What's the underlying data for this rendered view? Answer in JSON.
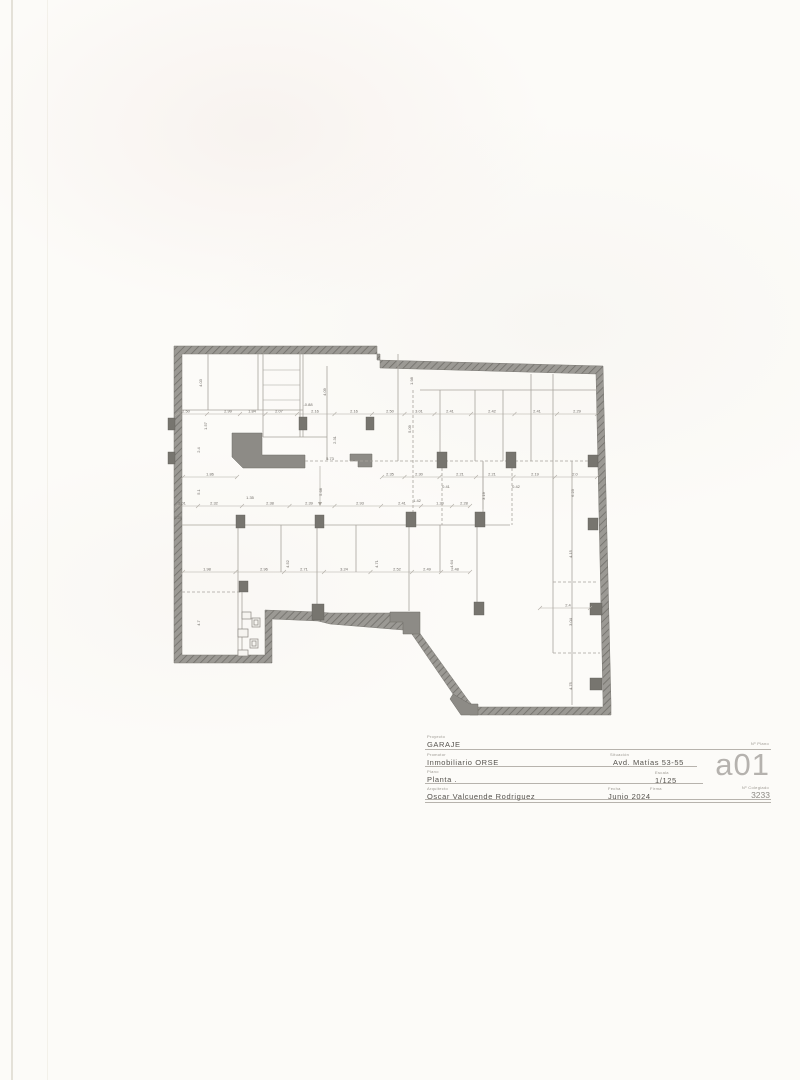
{
  "colors": {
    "paper": "#fcfbf8",
    "wall_fill": "#9b9994",
    "wall_hatch": "#716f6a",
    "dark_fill": "#77756f",
    "line": "#a8a49d",
    "dimline": "#b0aca4",
    "dim_text": "#6f6b66",
    "title_text": "#55524d",
    "label_text": "#9a968f",
    "plan_number_color": "#b5b2ae"
  },
  "plan": {
    "dim_rows": [
      {
        "y": 414,
        "x1": 177,
        "x2": 597,
        "labels": [
          {
            "x": 186,
            "t": "2.50"
          },
          {
            "x": 228,
            "t": "2.99"
          },
          {
            "x": 252,
            "t": "1.84"
          },
          {
            "x": 279,
            "t": "2.07"
          },
          {
            "x": 315,
            "t": "2.16"
          },
          {
            "x": 354,
            "t": "2.16"
          },
          {
            "x": 390,
            "t": "2.50"
          },
          {
            "x": 419,
            "t": "3.01"
          },
          {
            "x": 450,
            "t": "2.41"
          },
          {
            "x": 492,
            "t": "2.42"
          },
          {
            "x": 537,
            "t": "2.41"
          },
          {
            "x": 577,
            "t": "2.29"
          }
        ]
      },
      {
        "y": 477,
        "x1": 382,
        "x2": 597,
        "labels": [
          {
            "x": 390,
            "t": "2.35"
          },
          {
            "x": 419,
            "t": "2.30"
          },
          {
            "x": 460,
            "t": "2.21"
          },
          {
            "x": 492,
            "t": "2.21"
          },
          {
            "x": 535,
            "t": "2.19"
          },
          {
            "x": 575,
            "t": "2.0"
          }
        ]
      },
      {
        "y": 477,
        "x1": 183,
        "x2": 237,
        "labels": [
          {
            "x": 210,
            "t": "1.86"
          }
        ]
      },
      {
        "y": 506,
        "x1": 177,
        "x2": 470,
        "labels": [
          {
            "x": 182,
            "t": "2.01"
          },
          {
            "x": 214,
            "t": "2.32"
          },
          {
            "x": 270,
            "t": "2.38"
          },
          {
            "x": 309,
            "t": "2.39"
          },
          {
            "x": 360,
            "t": "2.93"
          },
          {
            "x": 402,
            "t": "2.41"
          },
          {
            "x": 440,
            "t": "1.20"
          },
          {
            "x": 464,
            "t": "2.28"
          }
        ]
      },
      {
        "y": 572,
        "x1": 183,
        "x2": 470,
        "labels": [
          {
            "x": 207,
            "t": "1.98"
          },
          {
            "x": 264,
            "t": "2.96"
          },
          {
            "x": 304,
            "t": "2.71"
          },
          {
            "x": 344,
            "t": "3.24"
          },
          {
            "x": 397,
            "t": "2.52"
          },
          {
            "x": 427,
            "t": "2.49"
          },
          {
            "x": 455,
            "t": "2.48"
          }
        ]
      },
      {
        "y": 608,
        "x1": 540,
        "x2": 590,
        "labels": [
          {
            "x": 568,
            "t": "2.4"
          }
        ]
      }
    ],
    "vdims": [
      {
        "x": 202,
        "y": 383,
        "t": "4.03"
      },
      {
        "x": 207,
        "y": 426,
        "t": "1.57"
      },
      {
        "x": 200,
        "y": 450,
        "t": "2.4"
      },
      {
        "x": 200,
        "y": 492,
        "t": "5.1"
      },
      {
        "x": 326,
        "y": 392,
        "t": "4.09"
      },
      {
        "x": 336,
        "y": 440,
        "t": "2.31"
      },
      {
        "x": 322,
        "y": 492,
        "t": "5.68"
      },
      {
        "x": 413,
        "y": 381,
        "t": "1.98"
      },
      {
        "x": 411,
        "y": 429,
        "t": "5.09"
      },
      {
        "x": 485,
        "y": 496,
        "t": "3.19"
      },
      {
        "x": 574,
        "y": 493,
        "t": "6.23"
      },
      {
        "x": 289,
        "y": 564,
        "t": "4.52"
      },
      {
        "x": 378,
        "y": 564,
        "t": "4.71"
      },
      {
        "x": 453,
        "y": 564,
        "t": "4.64"
      },
      {
        "x": 572,
        "y": 554,
        "t": "4.15"
      },
      {
        "x": 572,
        "y": 622,
        "t": "3.04"
      },
      {
        "x": 572,
        "y": 686,
        "t": "4.75"
      },
      {
        "x": 200,
        "y": 623,
        "t": "4.7"
      }
    ],
    "labels": [
      {
        "x": 308,
        "y": 406,
        "t": "-0.88"
      },
      {
        "x": 330,
        "y": 460,
        "t": "5.73"
      },
      {
        "x": 446,
        "y": 488,
        "t": "0.41"
      },
      {
        "x": 516,
        "y": 488,
        "t": "0.42"
      },
      {
        "x": 250,
        "y": 499,
        "t": "1.35"
      },
      {
        "x": 417,
        "y": 502,
        "t": "1.42"
      },
      {
        "x": 178,
        "y": 519,
        "t": "0.28"
      }
    ]
  },
  "title_block": {
    "project_label": "Proyecto",
    "project": "GARAJE",
    "promoter_label": "Promotor",
    "promoter": "Inmobiliario ORSE",
    "location_label": "Situación",
    "location": "Avd. Matías 53-55",
    "sheet_label": "Plano",
    "sheet": "Planta .",
    "scale_label": "Escala",
    "scale": "1/125",
    "author_label": "Arquitecto",
    "author": "Oscar Valcuende Rodriguez",
    "date_label": "Fecha",
    "date": "Junio 2024",
    "signature_label": "Firma",
    "signature": "",
    "sheet_number_label": "Nº Plano",
    "sheet_number": "a01",
    "license_label": "Nº Colegiado",
    "license_number": "3233"
  }
}
